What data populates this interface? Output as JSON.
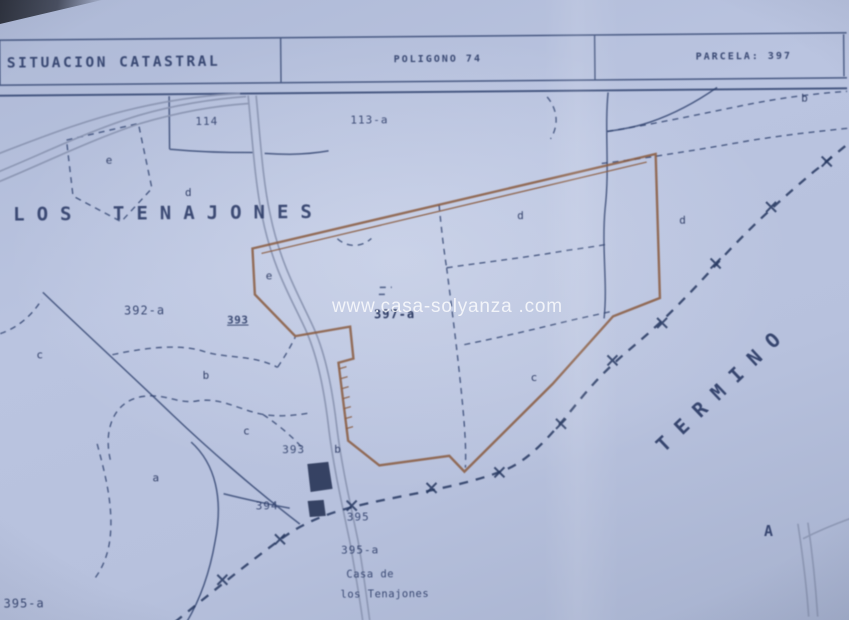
{
  "header": {
    "title": "SITUACION CATASTRAL",
    "poligono": "POLIGONO 74",
    "parcela": "PARCELA: 397"
  },
  "watermark": "www.casa-solyanza .com",
  "map": {
    "place_name": "LOS TENAJONES",
    "termino": "TERMINO",
    "labels": [
      {
        "name": "label-parcel-114",
        "text": "114",
        "x": 197,
        "y": 114,
        "cls": "num"
      },
      {
        "name": "label-parcel-113a",
        "text": "113-a",
        "x": 352,
        "y": 114,
        "cls": "num"
      },
      {
        "name": "label-parcel-392a",
        "text": "392-a",
        "x": 124,
        "y": 302,
        "cls": "num12"
      },
      {
        "name": "label-marker-393",
        "text": "393",
        "x": 227,
        "y": 313,
        "cls": "marker"
      },
      {
        "name": "label-parcel-397a",
        "text": "397-a",
        "x": 374,
        "y": 308,
        "cls": "boldnum"
      },
      {
        "name": "label-parcel-393",
        "text": "393",
        "x": 281,
        "y": 443,
        "cls": "num"
      },
      {
        "name": "label-parcel-394",
        "text": "394",
        "x": 254,
        "y": 499,
        "cls": "num"
      },
      {
        "name": "label-parcel-395",
        "text": "395",
        "x": 345,
        "y": 511,
        "cls": "num"
      },
      {
        "name": "label-parcel-395a",
        "text": "395-a",
        "x": 339,
        "y": 544,
        "cls": "num"
      },
      {
        "name": "label-casa-line1",
        "text": "Casa de",
        "x": 344,
        "y": 569,
        "cls": "small"
      },
      {
        "name": "label-casa-line2",
        "text": "los Tenajones",
        "x": 338,
        "y": 589,
        "cls": "small"
      },
      {
        "name": "label-parcel-395a-left",
        "text": "395-a",
        "x": 1,
        "y": 594,
        "cls": "num12"
      },
      {
        "name": "label-point-A",
        "text": "A",
        "x": 762,
        "y": 527,
        "cls": "cap"
      }
    ],
    "letters": [
      {
        "text": "e",
        "x": 107,
        "y": 152
      },
      {
        "text": "d",
        "x": 186,
        "y": 185
      },
      {
        "text": "e",
        "x": 266,
        "y": 269
      },
      {
        "text": "d",
        "x": 518,
        "y": 211
      },
      {
        "text": "c",
        "x": 530,
        "y": 373
      },
      {
        "text": "d",
        "x": 680,
        "y": 217
      },
      {
        "text": "b",
        "x": 803,
        "y": 96
      },
      {
        "text": "c",
        "x": 36,
        "y": 346
      },
      {
        "text": "b",
        "x": 202,
        "y": 368
      },
      {
        "text": "c",
        "x": 242,
        "y": 424
      },
      {
        "text": "a",
        "x": 151,
        "y": 470
      },
      {
        "text": "b",
        "x": 333,
        "y": 443
      }
    ],
    "colors": {
      "paper": "#b6c1dd",
      "ink": "#2c3e6b",
      "parcel_outline": "#8a5a3e",
      "road": "#8b96b2",
      "boundary": "#24365f",
      "building": "#1f2c4e",
      "watermark_text": "#ffffff"
    }
  }
}
